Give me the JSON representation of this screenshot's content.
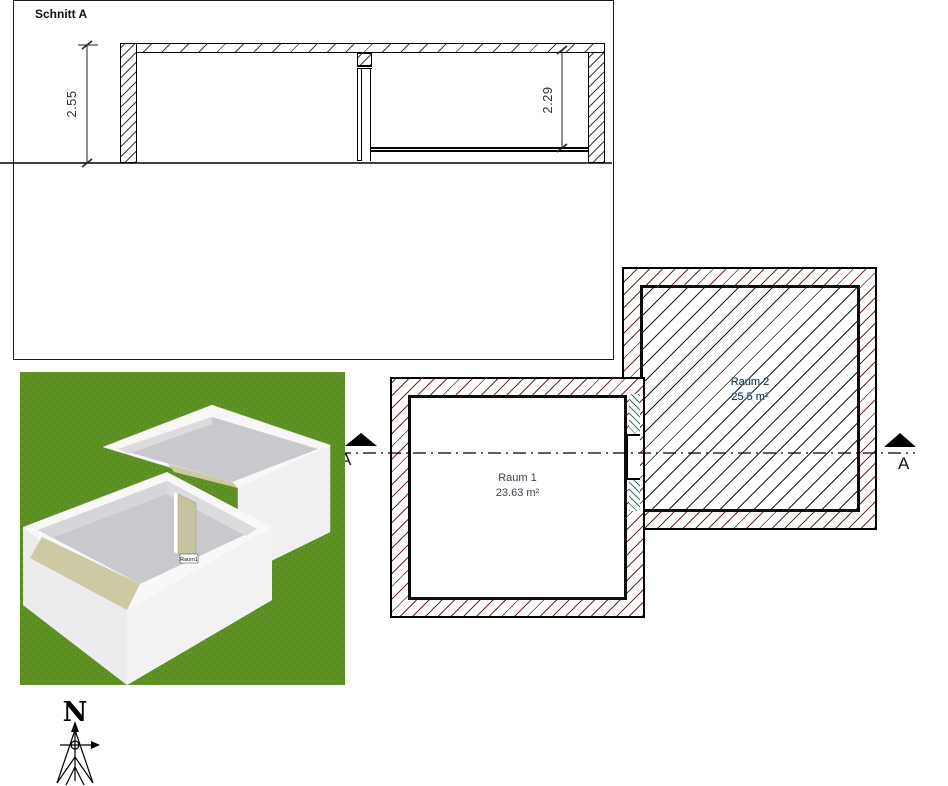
{
  "section_view": {
    "title": "Schnitt A",
    "dim_left": "2.55",
    "dim_right": "2.29"
  },
  "floor_plan": {
    "room1_name": "Raum 1",
    "room1_area": "23.63 m²",
    "room2_name": "Raum 2",
    "room2_area": "25.5 m²",
    "marker_left": "A",
    "marker_right": "A"
  },
  "view3d": {
    "room_tag": "Raum1"
  },
  "compass": {
    "north_label": "N"
  },
  "colors": {
    "wall_hatch": "#6b2a24",
    "room2_interior_hatch": "#1c1c1c",
    "insulation_hatch": "#2e7d74",
    "grass": "#5e9224",
    "paper": "#ffffff",
    "line": "#000000"
  }
}
